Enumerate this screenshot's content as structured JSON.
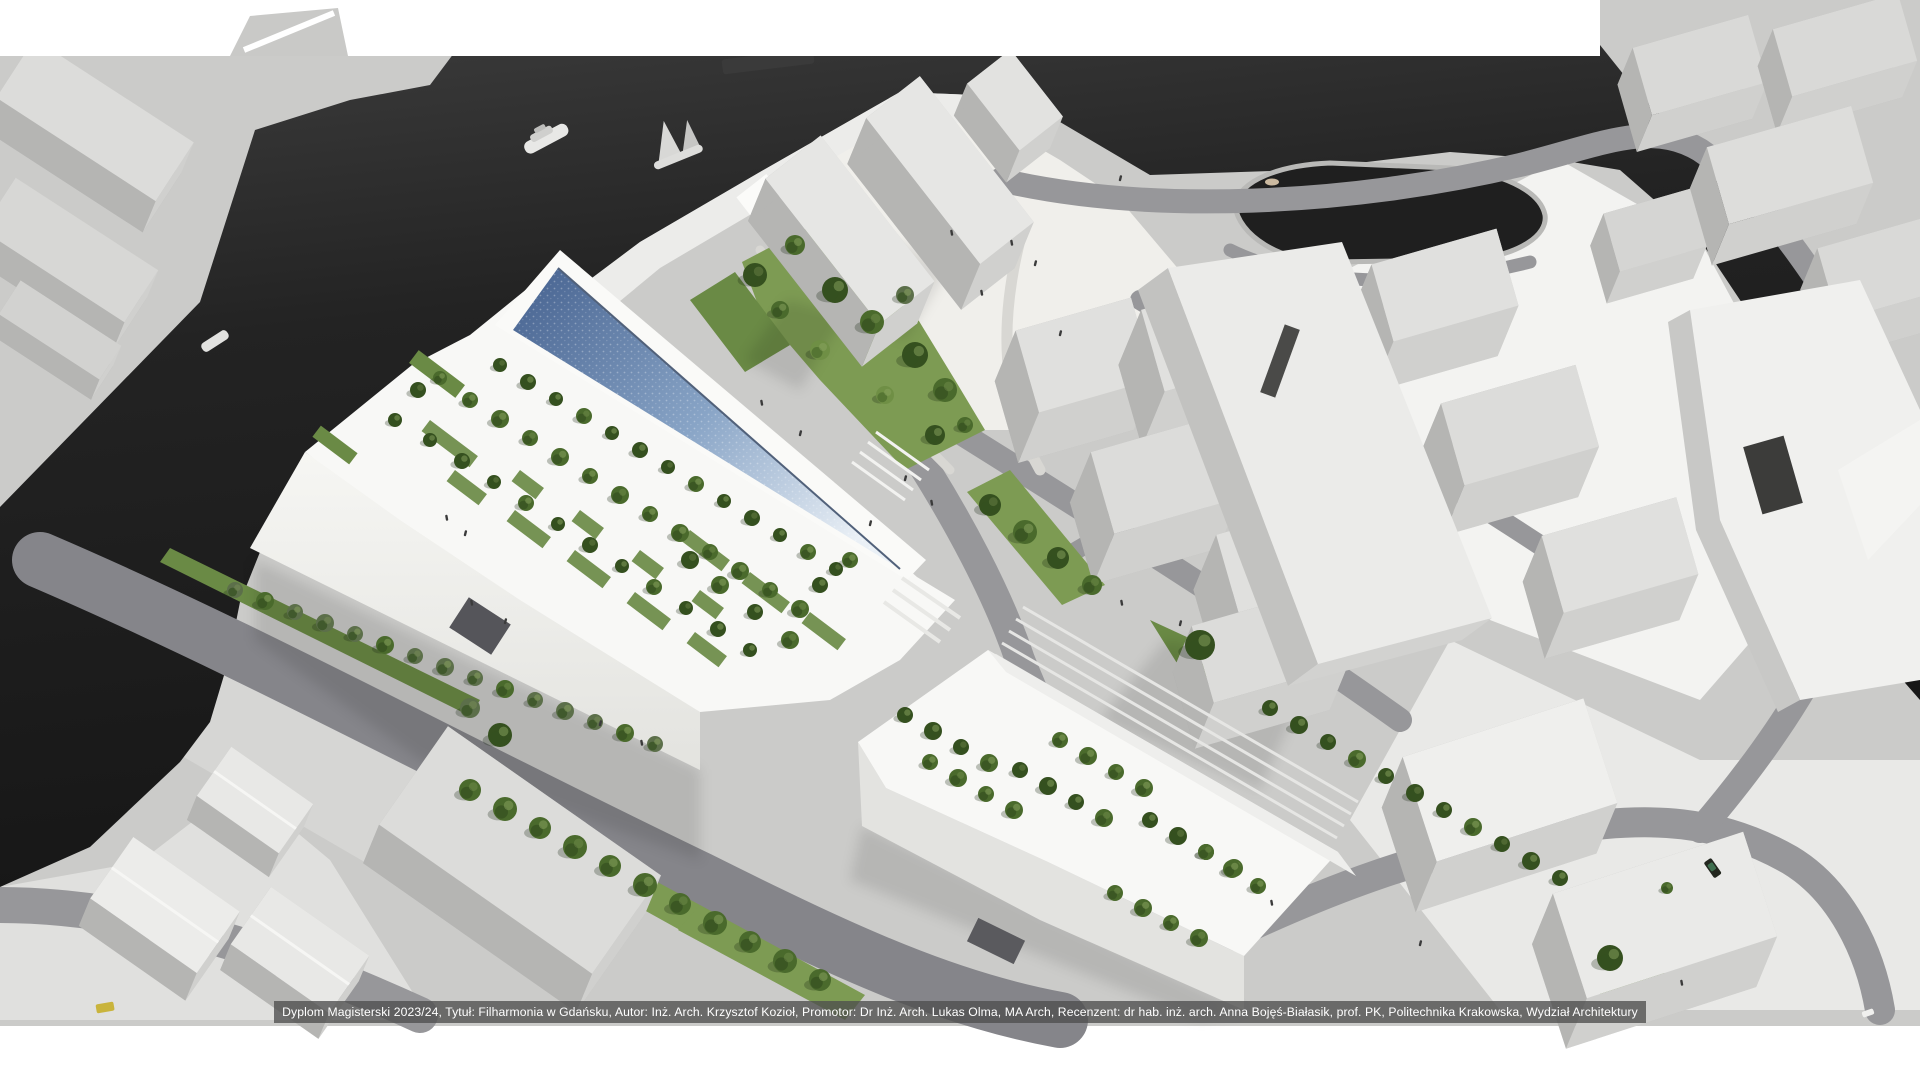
{
  "caption": {
    "text": "Dyplom Magisterski 2023/24, Tytuł: Filharmonia w Gdańsku, Autor: Inż. Arch. Krzysztof Kozioł, Promotor: Dr Inż. Arch. Lukas Olma, MA Arch, Recenzent: dr hab. inż. arch. Anna Bojęś-Białasik, prof. PK, Politechnika Krakowska, Wydział Architektury"
  },
  "palette": {
    "water_deep": "#161616",
    "water_light": "#3c3c3c",
    "glass_dark": "#44608e",
    "glass_mid": "#88a4c6",
    "glass_light": "#eaf0f6",
    "land": "#cbcbc9",
    "plaza": "#efeeea",
    "road": "#97979a",
    "road_dark": "#85858a",
    "lawn": "#7d9b53",
    "lawn_dark": "#6a8a45",
    "tree_dark": "#35501f",
    "tree_mid": "#4a6a2c",
    "tree_gray": "#5c6f4a",
    "tree_light": "#6f8f45",
    "building_white": "#f8f8f6",
    "building_roof": "#e2e2e0",
    "building_side": "#b9b9b7",
    "caption_bg": "rgba(78,78,78,0.78)",
    "caption_text": "#ffffff",
    "car_yellow": "#c9b43c"
  }
}
